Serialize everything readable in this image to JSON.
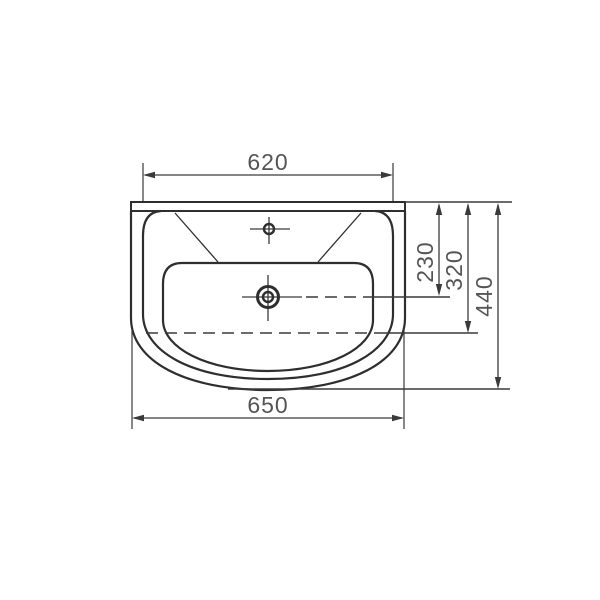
{
  "drawing": {
    "subject": "washbasin-top-view-technical-drawing",
    "background_color": "#ffffff",
    "line_color": "#2e2e2e",
    "dimension_line_color": "#3a3a3a",
    "text_color": "#555555",
    "dimensions": {
      "top_width": {
        "label": "620",
        "orientation": "horizontal",
        "position": "top"
      },
      "bottom_width": {
        "label": "650",
        "orientation": "horizontal",
        "position": "bottom"
      },
      "depth_to_drain_center": {
        "label": "230",
        "orientation": "vertical",
        "position": "right"
      },
      "depth_to_basin_back": {
        "label": "320",
        "orientation": "vertical",
        "position": "right"
      },
      "overall_depth": {
        "label": "440",
        "orientation": "vertical",
        "position": "right"
      }
    },
    "features": {
      "faucet_hole": "small circle with crosshair near top center",
      "drain": "double circle with crosshair at basin center",
      "hidden_lines": "dashed centerline from drain and dashed basin back edge"
    }
  }
}
